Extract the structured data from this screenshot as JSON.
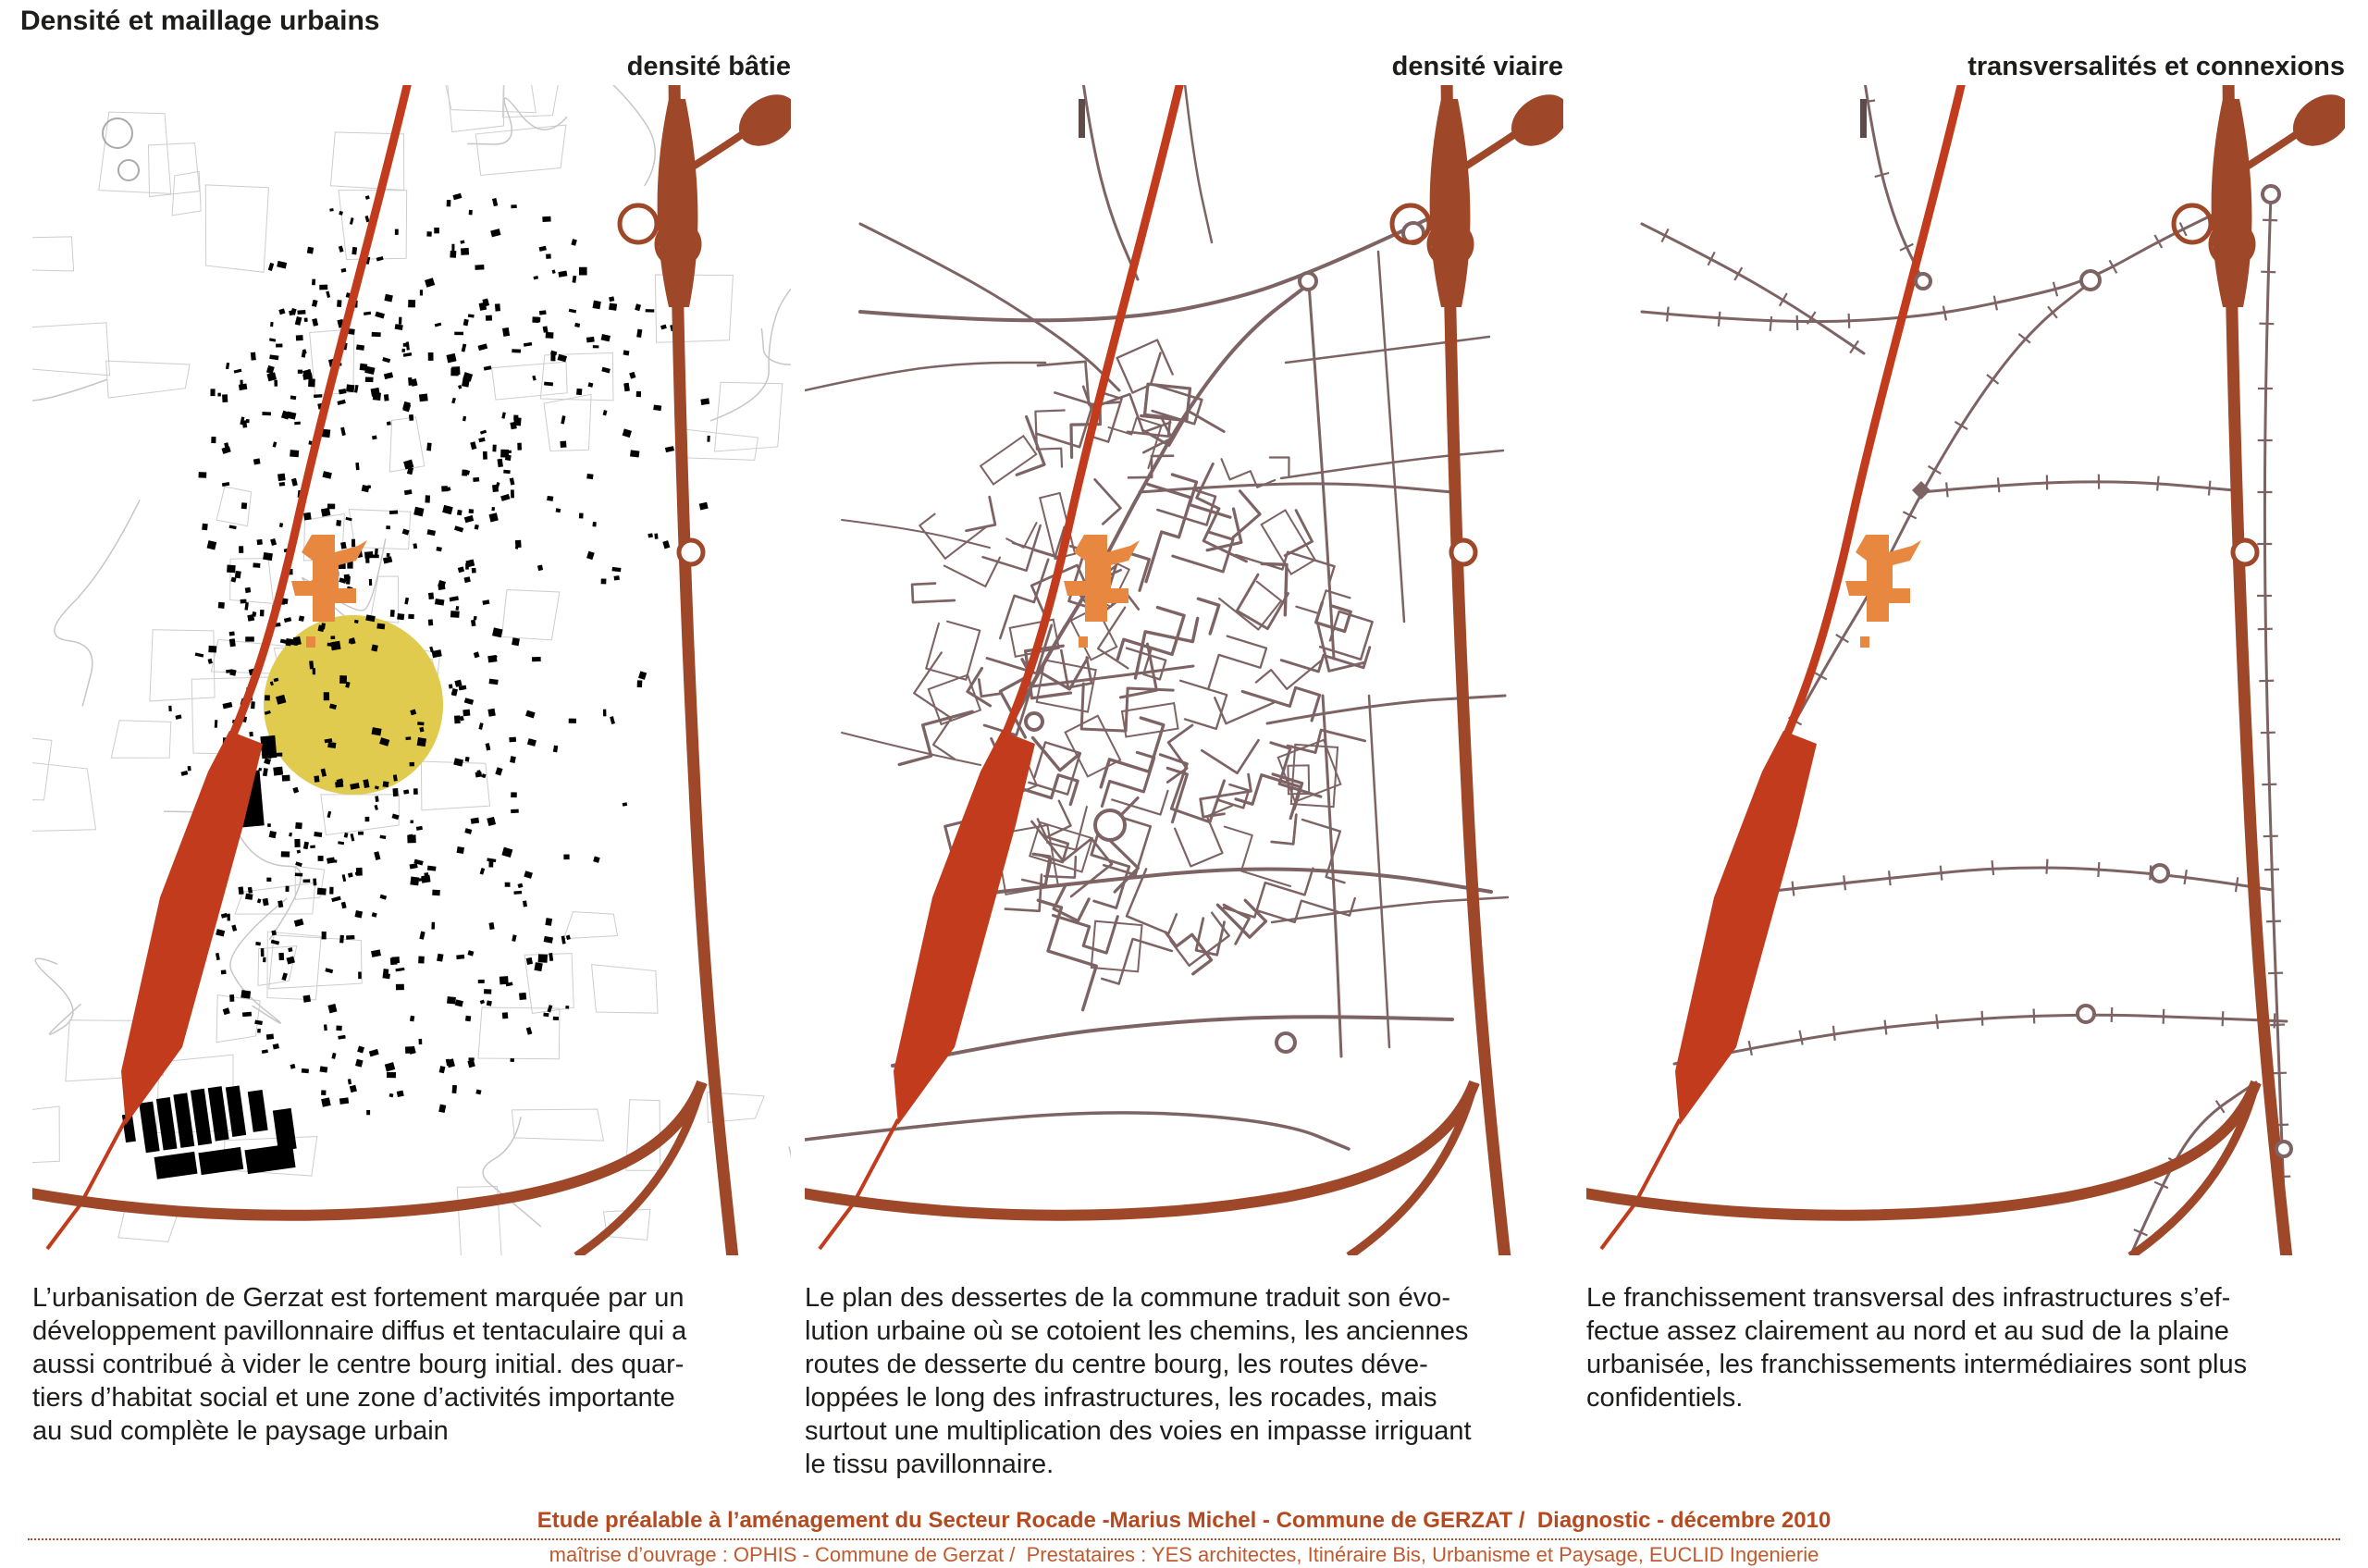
{
  "page": {
    "title": "Densité et maillage urbains"
  },
  "panels": [
    {
      "title": "densité bâtie",
      "caption_lines": [
        "L’urbanisation de Gerzat est fortement marquée par un",
        "développement pavillonnaire diffus et tentaculaire qui a",
        "aussi contribué à vider le centre bourg initial. des quar-",
        "tiers d’habitat social et une zone d’activités importante",
        "au sud complète le paysage urbain"
      ]
    },
    {
      "title": "densité viaire",
      "caption_lines": [
        "Le plan des dessertes de la commune traduit son évo-",
        "lution urbaine où se cotoient les chemins, les anciennes",
        "routes de desserte du centre bourg, les routes déve-",
        "loppées le long des infrastructures, les rocades, mais",
        "surtout une multiplication des voies en impasse irriguant",
        "le tissu pavillonnaire."
      ]
    },
    {
      "title": "transversalités et connexions",
      "caption_lines": [
        "Le franchissement transversal des infrastructures s’ef-",
        "fectue assez clairement au nord et au sud de la plaine",
        "urbanisée, les franchissements intermédiaires sont plus",
        "confidentiels."
      ]
    }
  ],
  "footer": {
    "line1": "Etude préalable à l’aménagement du Secteur Rocade -Marius Michel - Commune de GERZAT /  Diagnostic - décembre 2010",
    "line2": "maîtrise d’ouvrage : OPHIS - Commune de Gerzat /  Prestataires : YES architectes, Itinéraire Bis, Urbanisme et Paysage, EUCLID Ingenierie"
  },
  "colors": {
    "main_road_red": "#c23b1c",
    "bypass_brown": "#9e4729",
    "street_taupe": "#7d6363",
    "extension_orange": "#e8873f",
    "centre_bourg_yellow": "#e0cb4f",
    "building_black": "#000000",
    "parcel_gray": "#cdcdcd",
    "footer_orange": "#b5491f"
  }
}
